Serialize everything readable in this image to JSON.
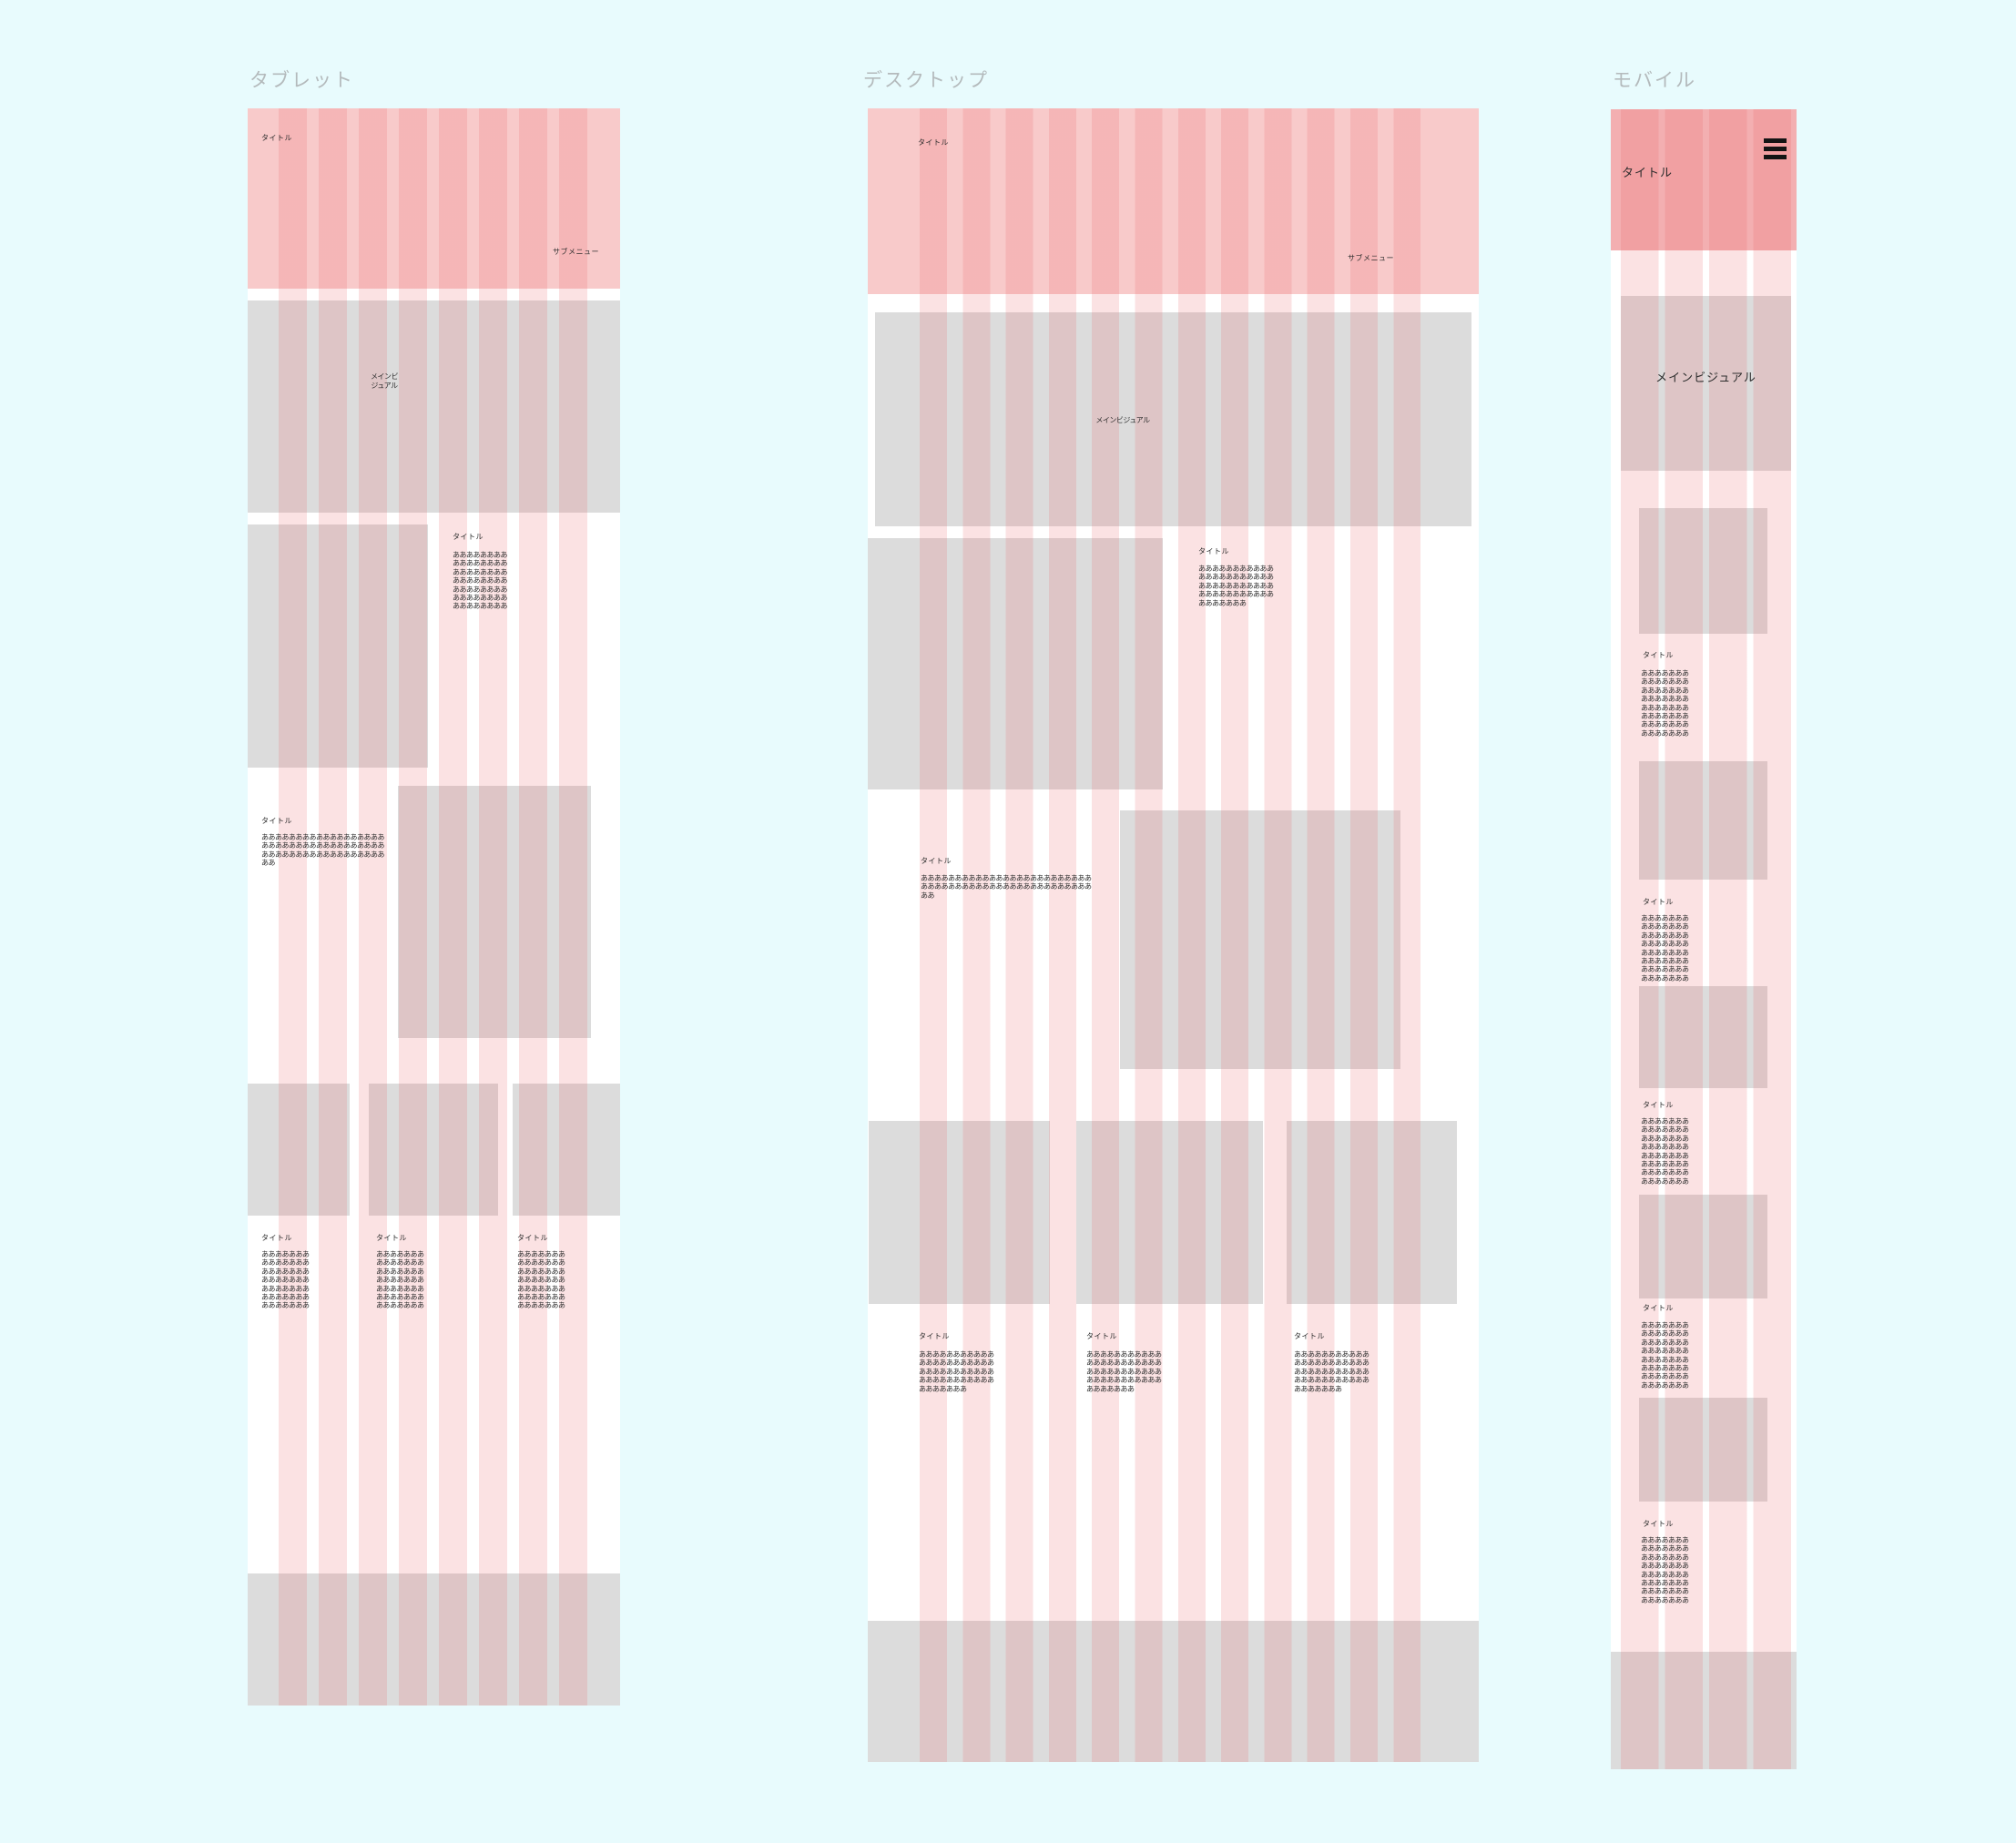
{
  "colors": {
    "canvas_bg": "#e8fbfd",
    "grid_stripe_red": "rgba(232,85,90,0.17)",
    "header_pink": "#f8caca",
    "mobile_header_pink": "#f3afb1",
    "placeholder_gray": "#dcdcdc",
    "frame_label_gray": "#b4babc",
    "text": "#2d2d2d"
  },
  "artboards": {
    "tablet": {
      "label": "タブレット",
      "header": {
        "title": "タイトル",
        "submenu": "サブメニュー"
      },
      "main_visual": "メインビ\nジュアル",
      "section_a": {
        "title": "タイトル",
        "body": "ああああああああ\nああああああああ\nああああああああ\nああああああああ\nああああああああ\nああああああああ\nああああああああ"
      },
      "section_b": {
        "title": "タイトル",
        "body": "ああああああああああああああああああ\nああああああああああああああああああ\nああああああああああああああああああ\nああ"
      },
      "cards": [
        {
          "title": "タイトル",
          "body": "あああああああ\nあああああああ\nあああああああ\nあああああああ\nあああああああ\nあああああああ\nあああああああ"
        },
        {
          "title": "タイトル",
          "body": "あああああああ\nあああああああ\nあああああああ\nあああああああ\nあああああああ\nあああああああ\nあああああああ"
        },
        {
          "title": "タイトル",
          "body": "あああああああ\nあああああああ\nあああああああ\nあああああああ\nあああああああ\nあああああああ\nあああああああ"
        }
      ]
    },
    "desktop": {
      "label": "デスクトップ",
      "header": {
        "title": "タイトル",
        "submenu": "サブメニュー"
      },
      "main_visual": "メインビジュアル",
      "section_a": {
        "title": "タイトル",
        "body": "あああああああああああ\nあああああああああああ\nあああああああああああ\nあああああああああああ\nあああああああ"
      },
      "section_b": {
        "title": "タイトル",
        "body": "あああああああああああああああああああああああああ\nあああああああああああああああああああああああああ\nああ"
      },
      "cards": [
        {
          "title": "タイトル",
          "body": "あああああああああああ\nあああああああああああ\nあああああああああああ\nあああああああああああ\nあああああああ"
        },
        {
          "title": "タイトル",
          "body": "あああああああああああ\nあああああああああああ\nあああああああああああ\nあああああああああああ\nあああああああ"
        },
        {
          "title": "タイトル",
          "body": "あああああああああああ\nあああああああああああ\nあああああああああああ\nあああああああああああ\nあああああああ"
        }
      ]
    },
    "mobile": {
      "label": "モバイル",
      "header": {
        "title": "タイトル",
        "menu_icon": "hamburger-menu-icon"
      },
      "main_visual": "メインビジュアル",
      "items": [
        {
          "title": "タイトル",
          "body": "あああああああ\nあああああああ\nあああああああ\nあああああああ\nあああああああ\nあああああああ\nあああああああ\nあああああああ"
        },
        {
          "title": "タイトル",
          "body": "あああああああ\nあああああああ\nあああああああ\nあああああああ\nあああああああ\nあああああああ\nあああああああ\nあああああああ"
        },
        {
          "title": "タイトル",
          "body": "あああああああ\nあああああああ\nあああああああ\nあああああああ\nあああああああ\nあああああああ\nあああああああ\nあああああああ"
        },
        {
          "title": "タイトル",
          "body": "あああああああ\nあああああああ\nあああああああ\nあああああああ\nあああああああ\nあああああああ\nあああああああ\nあああああああ"
        },
        {
          "title": "タイトル",
          "body": "あああああああ\nあああああああ\nあああああああ\nあああああああ\nあああああああ\nあああああああ\nあああああああ\nあああああああ"
        }
      ]
    }
  }
}
